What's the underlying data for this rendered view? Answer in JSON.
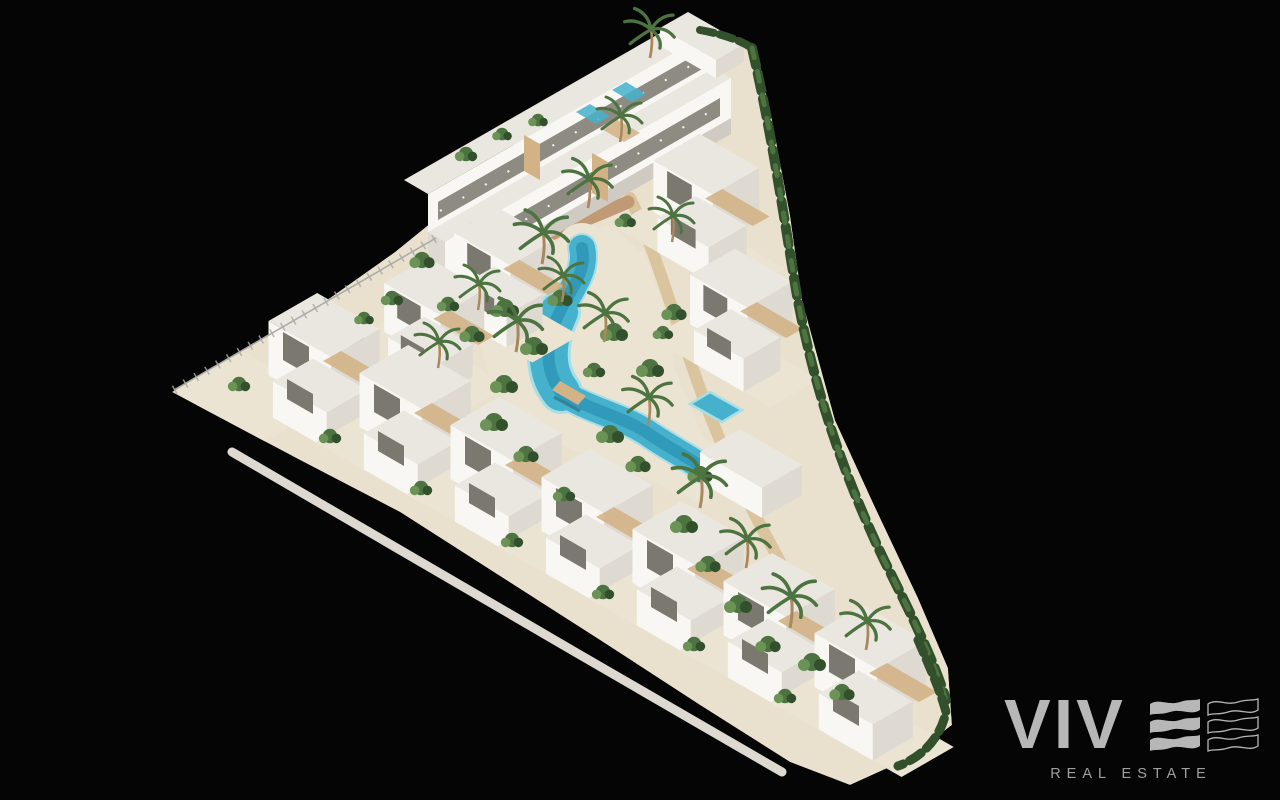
{
  "scene": {
    "type": "aerial-3d-architectural-render",
    "subject": "White Mediterranean residential complex with winding lagoon-style pool, terraced apartment block, rows of villas, palm trees and gardens on a black background"
  },
  "logo": {
    "brand": "VIV",
    "tagline": "REAL ESTATE",
    "wave_filled_icon": "triple-wave-e-filled-icon",
    "wave_outline_icon": "triple-wave-e-outline-icon"
  },
  "colors": {
    "background": "#050505",
    "ground": "#e9e1cd",
    "beach": "#ece4d3",
    "sand_path": "#d8c29a",
    "terracotta_path": "#c09a74",
    "wall_light": "#f8f7f3",
    "wall_shade": "#dedad2",
    "roof": "#e9e7e0",
    "plinth": "#cfcbc2",
    "window": "#7b786f",
    "wood": "#d3b286",
    "pool": "#45b1cc",
    "pool_deep": "#2a90b2",
    "pool_light": "#a8dfe6",
    "green_dark": "#33502c",
    "green_mid": "#4c7340",
    "green_light": "#6b9355",
    "palm_trunk": "#a8885e",
    "fence": "#a9a9a7",
    "wall_base": "#ddd9d0",
    "logo_gray": "#b7b7b7",
    "logo_text": "#a0a0a0"
  }
}
